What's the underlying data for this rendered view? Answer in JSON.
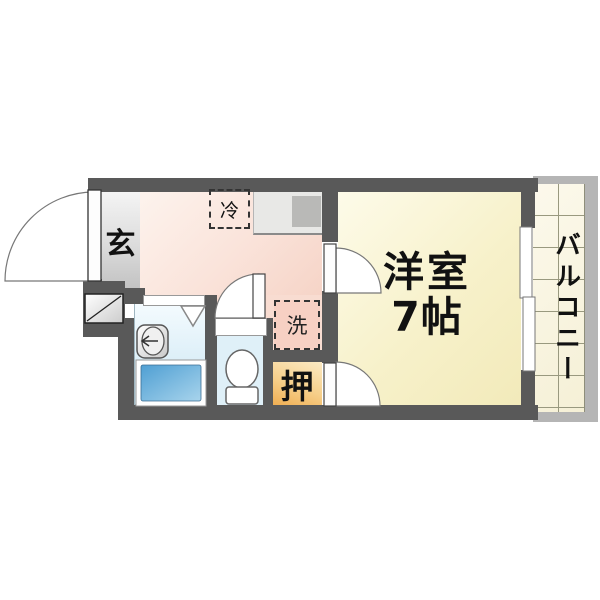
{
  "floor_plan": {
    "type": "japanese-apartment-floorplan",
    "rooms": {
      "entrance": {
        "label": "玄"
      },
      "kitchen": {
        "fridge_label": "冷",
        "washer_label": "洗"
      },
      "closet": {
        "label": "押"
      },
      "western_room": {
        "label_line1": "洋室",
        "label_line2": "7帖"
      },
      "balcony": {
        "label": "バルコニー"
      }
    },
    "colors": {
      "wall": "#595959",
      "kitchen_pink": "#f6d4c7",
      "western_room_cream": "#f2eaba",
      "closet_orange": "#efae52",
      "entrance_gray": "#c2c2c2",
      "bathroom_blue": "#cfe9f5",
      "toilet_blue": "#dff0f8",
      "bathtub_blue": "#4f9fd3",
      "balcony_tile": "#f5f0d6",
      "balcony_frame": "#b5b5b5",
      "counter_gray": "#e8e8e6",
      "stove_gray": "#b9b9b7",
      "background": "#ffffff"
    }
  }
}
